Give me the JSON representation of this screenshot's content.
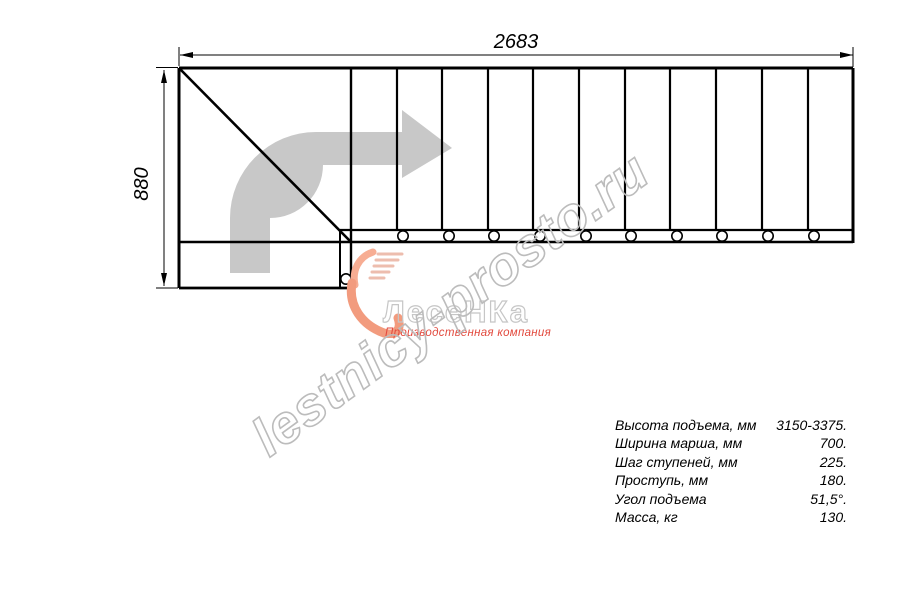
{
  "colors": {
    "line-black": "#000000",
    "arrow-gray": "#c8c8c8",
    "watermark-gray": "#bcbcbc",
    "logo-gray": "#c6c6c6",
    "brand-red": "#e2493d",
    "brand-salmon": "#f5a78c"
  },
  "diagram": {
    "width_label": "2683",
    "height_label": "880",
    "tread_count": 11
  },
  "watermark": {
    "text": "lestnicy-prosto.ru"
  },
  "logo": {
    "name": "ЛесеНКа",
    "tagline": "Производственная компания"
  },
  "specs": {
    "rows": [
      {
        "label": "Высота подъема, мм",
        "value": "3150-3375."
      },
      {
        "label": "Ширина марша, мм",
        "value": "700."
      },
      {
        "label": "Шаг ступеней, мм",
        "value": "225."
      },
      {
        "label": "Проступь, мм",
        "value": "180."
      },
      {
        "label": "Угол подъема",
        "value": "51,5°."
      },
      {
        "label": "Масса, кг",
        "value": "130."
      }
    ]
  }
}
